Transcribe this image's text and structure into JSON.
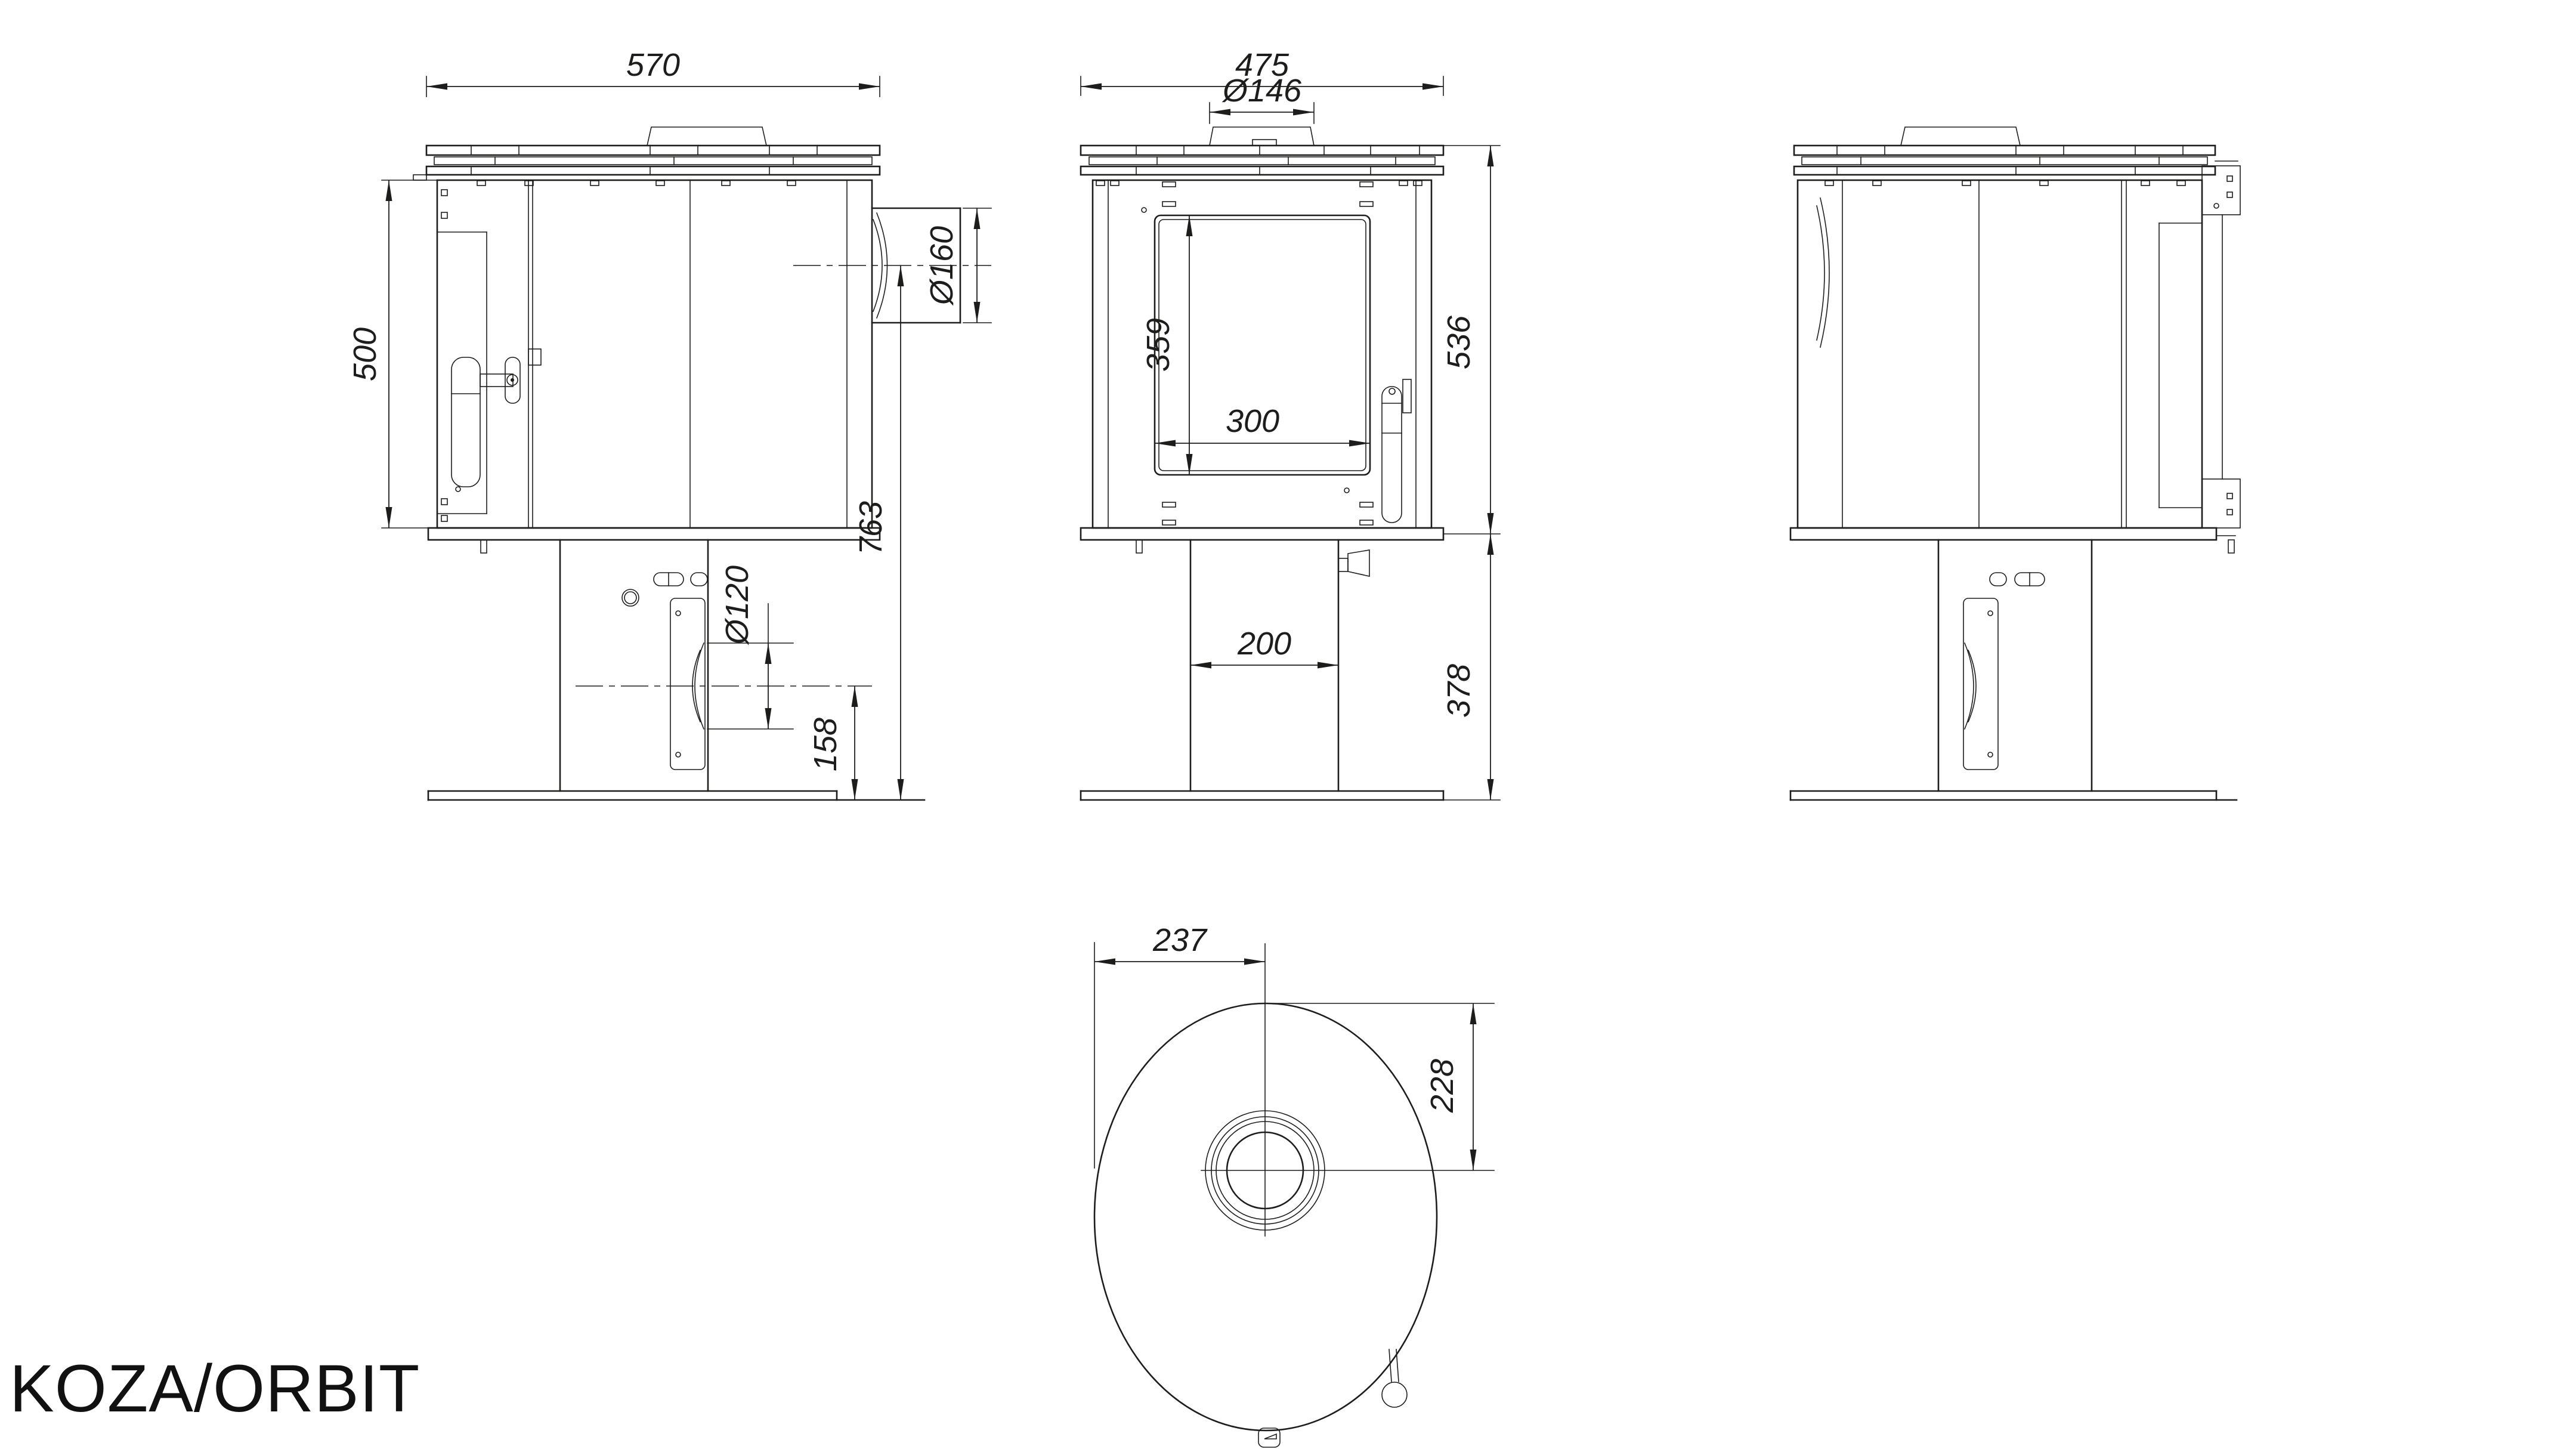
{
  "title": "KOZA/ORBIT",
  "drawing": {
    "type": "technical-dimension-drawing",
    "product": "free-standing stove, three elevation views and one top view",
    "line_color": "#1d1d1b",
    "background_color": "#ffffff"
  },
  "labels": {
    "side_left": {
      "top_width": "570",
      "body_height": "500",
      "flue_diameter": "Ø160",
      "flue_center_to_floor": "763",
      "rear_outlet_diameter": "Ø120",
      "rear_outlet_center_to_floor": "158"
    },
    "front": {
      "top_width": "475",
      "collar_diameter": "Ø146",
      "glass_height": "359",
      "glass_width": "300",
      "body_height": "536",
      "pedestal_height": "378",
      "pedestal_width": "200"
    },
    "top": {
      "front_depth": "237",
      "rear_depth": "228"
    }
  }
}
